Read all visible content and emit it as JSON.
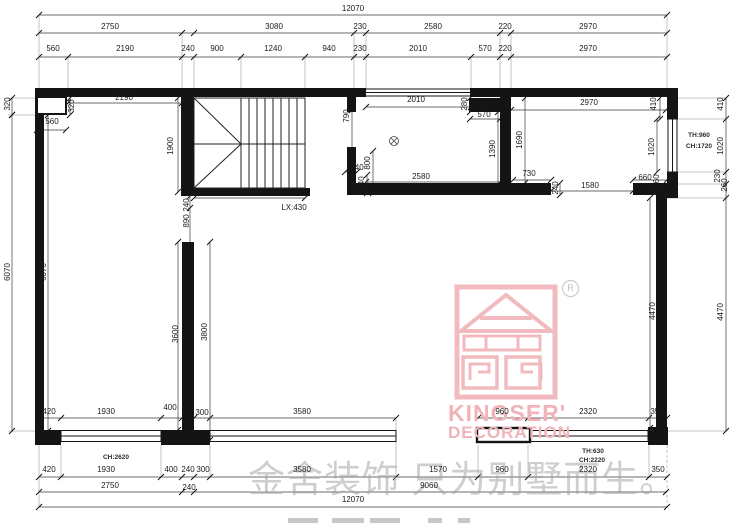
{
  "watermark": {
    "text": "金舍装饰 只为别墅而生。"
  },
  "logo": {
    "brand": "KINGSER'",
    "sub": "DECORATION",
    "registered": "R"
  },
  "labels": [
    {
      "t": "12070",
      "x": 353,
      "y": 9
    },
    {
      "t": "2750",
      "x": 110,
      "y": 27
    },
    {
      "t": "3080",
      "x": 274,
      "y": 27
    },
    {
      "t": "230",
      "x": 360,
      "y": 27
    },
    {
      "t": "2580",
      "x": 433,
      "y": 27
    },
    {
      "t": "220",
      "x": 505,
      "y": 27
    },
    {
      "t": "2970",
      "x": 588,
      "y": 27
    },
    {
      "t": "560",
      "x": 53,
      "y": 49
    },
    {
      "t": "2190",
      "x": 125,
      "y": 49
    },
    {
      "t": "240",
      "x": 188,
      "y": 49
    },
    {
      "t": "900",
      "x": 217,
      "y": 49
    },
    {
      "t": "1240",
      "x": 273,
      "y": 49
    },
    {
      "t": "940",
      "x": 329,
      "y": 49
    },
    {
      "t": "230",
      "x": 360,
      "y": 49
    },
    {
      "t": "2010",
      "x": 418,
      "y": 49
    },
    {
      "t": "570",
      "x": 485,
      "y": 49
    },
    {
      "t": "220",
      "x": 505,
      "y": 49
    },
    {
      "t": "2970",
      "x": 588,
      "y": 49
    },
    {
      "t": "320",
      "x": 8,
      "y": 104,
      "r": 1
    },
    {
      "t": "6070",
      "x": 8,
      "y": 272,
      "r": 1
    },
    {
      "t": "6070",
      "x": 44,
      "y": 272,
      "r": 1
    },
    {
      "t": "320",
      "x": 72,
      "y": 106,
      "r": 1
    },
    {
      "t": "560",
      "x": 52,
      "y": 122
    },
    {
      "t": "2190",
      "x": 124,
      "y": 98
    },
    {
      "t": "1900",
      "x": 171,
      "y": 146,
      "r": 1
    },
    {
      "t": "2140",
      "x": 248,
      "y": 192
    },
    {
      "t": "LX:430",
      "x": 294,
      "y": 208
    },
    {
      "t": "240",
      "x": 187,
      "y": 205,
      "r": 1
    },
    {
      "t": "890",
      "x": 187,
      "y": 221,
      "r": 1
    },
    {
      "t": "3600",
      "x": 176,
      "y": 334,
      "r": 1
    },
    {
      "t": "3800",
      "x": 205,
      "y": 332,
      "r": 1
    },
    {
      "t": "790",
      "x": 347,
      "y": 116,
      "r": 1
    },
    {
      "t": "800",
      "x": 368,
      "y": 163,
      "r": 1
    },
    {
      "t": "240",
      "x": 357,
      "y": 168
    },
    {
      "t": "340",
      "x": 362,
      "y": 183,
      "r": 1
    },
    {
      "t": "2010",
      "x": 416,
      "y": 100
    },
    {
      "t": "280",
      "x": 465,
      "y": 104,
      "r": 1
    },
    {
      "t": "570",
      "x": 484,
      "y": 115
    },
    {
      "t": "1390",
      "x": 493,
      "y": 149,
      "r": 1
    },
    {
      "t": "2580",
      "x": 421,
      "y": 177
    },
    {
      "t": "2970",
      "x": 589,
      "y": 103
    },
    {
      "t": "1690",
      "x": 520,
      "y": 140,
      "r": 1
    },
    {
      "t": "410",
      "x": 654,
      "y": 104,
      "r": 1
    },
    {
      "t": "1020",
      "x": 652,
      "y": 147,
      "r": 1
    },
    {
      "t": "730",
      "x": 529,
      "y": 174
    },
    {
      "t": "240",
      "x": 556,
      "y": 188,
      "r": 1
    },
    {
      "t": "1580",
      "x": 590,
      "y": 186
    },
    {
      "t": "660",
      "x": 645,
      "y": 178
    },
    {
      "t": "260",
      "x": 657,
      "y": 181,
      "r": 1
    },
    {
      "t": "4470",
      "x": 653,
      "y": 311,
      "r": 1
    },
    {
      "t": "410",
      "x": 721,
      "y": 104,
      "r": 1
    },
    {
      "t": "1020",
      "x": 721,
      "y": 146,
      "r": 1
    },
    {
      "t": "230",
      "x": 718,
      "y": 176,
      "r": 1
    },
    {
      "t": "260",
      "x": 725,
      "y": 185,
      "r": 1
    },
    {
      "t": "4470",
      "x": 721,
      "y": 312,
      "r": 1
    },
    {
      "t": "TH:960",
      "x": 699,
      "y": 136,
      "f": 1
    },
    {
      "t": "CH:1720",
      "x": 699,
      "y": 147,
      "f": 1
    },
    {
      "t": "420",
      "x": 49,
      "y": 412
    },
    {
      "t": "1930",
      "x": 106,
      "y": 412
    },
    {
      "t": "400",
      "x": 170,
      "y": 408
    },
    {
      "t": "300",
      "x": 202,
      "y": 413
    },
    {
      "t": "3580",
      "x": 302,
      "y": 412
    },
    {
      "t": "960",
      "x": 502,
      "y": 412
    },
    {
      "t": "2320",
      "x": 588,
      "y": 412
    },
    {
      "t": "350",
      "x": 657,
      "y": 412
    },
    {
      "t": "CH:2620",
      "x": 116,
      "y": 458,
      "f": 1
    },
    {
      "t": "TH:630",
      "x": 593,
      "y": 452,
      "f": 1
    },
    {
      "t": "CH:2220",
      "x": 592,
      "y": 461,
      "f": 1
    },
    {
      "t": "420",
      "x": 49,
      "y": 470
    },
    {
      "t": "1930",
      "x": 106,
      "y": 470
    },
    {
      "t": "400",
      "x": 171,
      "y": 470
    },
    {
      "t": "240",
      "x": 188,
      "y": 470
    },
    {
      "t": "300",
      "x": 203,
      "y": 470
    },
    {
      "t": "3580",
      "x": 302,
      "y": 470
    },
    {
      "t": "1570",
      "x": 438,
      "y": 470
    },
    {
      "t": "960",
      "x": 502,
      "y": 470
    },
    {
      "t": "2320",
      "x": 588,
      "y": 470
    },
    {
      "t": "350",
      "x": 658,
      "y": 470
    },
    {
      "t": "2750",
      "x": 110,
      "y": 486
    },
    {
      "t": "240",
      "x": 189,
      "y": 488
    },
    {
      "t": "9060",
      "x": 429,
      "y": 486
    },
    {
      "t": "12070",
      "x": 353,
      "y": 500
    }
  ],
  "dimlines": {
    "h": [
      {
        "y": 15,
        "x1": 39,
        "x2": 667,
        "ticks": [
          39,
          667
        ]
      },
      {
        "y": 33,
        "x1": 39,
        "x2": 667,
        "ticks": [
          39,
          182,
          194,
          354,
          366,
          500,
          511,
          667
        ]
      },
      {
        "y": 57,
        "x1": 39,
        "x2": 667,
        "ticks": [
          39,
          68,
          182,
          194,
          241,
          305,
          354,
          366,
          471,
          500,
          511,
          667
        ]
      },
      {
        "y": 103,
        "x1": 68,
        "x2": 182,
        "ticks": [
          68,
          182
        ]
      },
      {
        "y": 130,
        "x1": 37,
        "x2": 66,
        "ticks": [
          37,
          66
        ]
      },
      {
        "y": 107,
        "x1": 366,
        "x2": 471,
        "ticks": [
          366,
          471
        ]
      },
      {
        "y": 119,
        "x1": 470,
        "x2": 500,
        "ticks": [
          470,
          500
        ]
      },
      {
        "y": 110,
        "x1": 511,
        "x2": 666,
        "ticks": [
          511,
          666
        ]
      },
      {
        "y": 182,
        "x1": 366,
        "x2": 500,
        "ticks": [
          366,
          500
        ]
      },
      {
        "y": 198,
        "x1": 194,
        "x2": 305,
        "ticks": [
          194,
          305
        ]
      },
      {
        "y": 180,
        "x1": 513,
        "x2": 551,
        "ticks": [
          513,
          551
        ]
      },
      {
        "y": 191,
        "x1": 551,
        "x2": 633,
        "ticks": [
          551,
          633
        ]
      },
      {
        "y": 180,
        "x1": 633,
        "x2": 667,
        "ticks": [
          633,
          667
        ]
      },
      {
        "y": 172,
        "x1": 345,
        "x2": 357,
        "ticks": [
          345,
          357
        ]
      },
      {
        "y": 418,
        "x1": 39,
        "x2": 396,
        "ticks": [
          39,
          61,
          161,
          182,
          194,
          210,
          396
        ]
      },
      {
        "y": 418,
        "x1": 478,
        "x2": 667,
        "ticks": [
          478,
          528,
          649,
          667
        ]
      },
      {
        "y": 477,
        "x1": 39,
        "x2": 667,
        "ticks": [
          39,
          61,
          161,
          182,
          194,
          210,
          396,
          478,
          528,
          649,
          667
        ]
      },
      {
        "y": 492,
        "x1": 39,
        "x2": 667,
        "ticks": [
          39,
          182,
          194,
          666
        ]
      },
      {
        "y": 507,
        "x1": 39,
        "x2": 667,
        "ticks": [
          39,
          667
        ]
      }
    ],
    "v": [
      {
        "x": 12,
        "y1": 98,
        "y2": 115,
        "ticks": [
          98,
          115
        ]
      },
      {
        "x": 12,
        "y1": 115,
        "y2": 431,
        "ticks": [
          115,
          431
        ]
      },
      {
        "x": 48,
        "y1": 115,
        "y2": 431,
        "ticks": [
          115,
          431
        ]
      },
      {
        "x": 70,
        "y1": 98,
        "y2": 115,
        "ticks": [
          98,
          115
        ]
      },
      {
        "x": 178,
        "y1": 98,
        "y2": 192,
        "ticks": [
          98,
          192
        ]
      },
      {
        "x": 190,
        "y1": 196,
        "y2": 254,
        "ticks": [
          196,
          208,
          254
        ]
      },
      {
        "x": 178,
        "y1": 242,
        "y2": 430,
        "ticks": [
          242,
          430
        ]
      },
      {
        "x": 210,
        "y1": 242,
        "y2": 440,
        "ticks": [
          242,
          440
        ]
      },
      {
        "x": 352,
        "y1": 110,
        "y2": 151,
        "ticks": [
          110,
          151
        ]
      },
      {
        "x": 373,
        "y1": 151,
        "y2": 193,
        "ticks": [
          151,
          193
        ]
      },
      {
        "x": 367,
        "y1": 175,
        "y2": 193,
        "ticks": [
          175,
          193
        ]
      },
      {
        "x": 470,
        "y1": 98,
        "y2": 112,
        "ticks": [
          98,
          112
        ]
      },
      {
        "x": 498,
        "y1": 112,
        "y2": 190,
        "ticks": [
          112,
          190
        ]
      },
      {
        "x": 525,
        "y1": 98,
        "y2": 183,
        "ticks": [
          98,
          183
        ]
      },
      {
        "x": 560,
        "y1": 183,
        "y2": 195,
        "ticks": [
          183,
          195
        ]
      },
      {
        "x": 660,
        "y1": 98,
        "y2": 119,
        "ticks": [
          98,
          119
        ]
      },
      {
        "x": 657,
        "y1": 119,
        "y2": 172,
        "ticks": [
          119,
          172
        ]
      },
      {
        "x": 650,
        "y1": 198,
        "y2": 428,
        "ticks": [
          198,
          428
        ]
      },
      {
        "x": 726,
        "y1": 98,
        "y2": 431,
        "ticks": [
          98,
          119,
          172,
          184,
          198,
          431
        ]
      }
    ]
  }
}
